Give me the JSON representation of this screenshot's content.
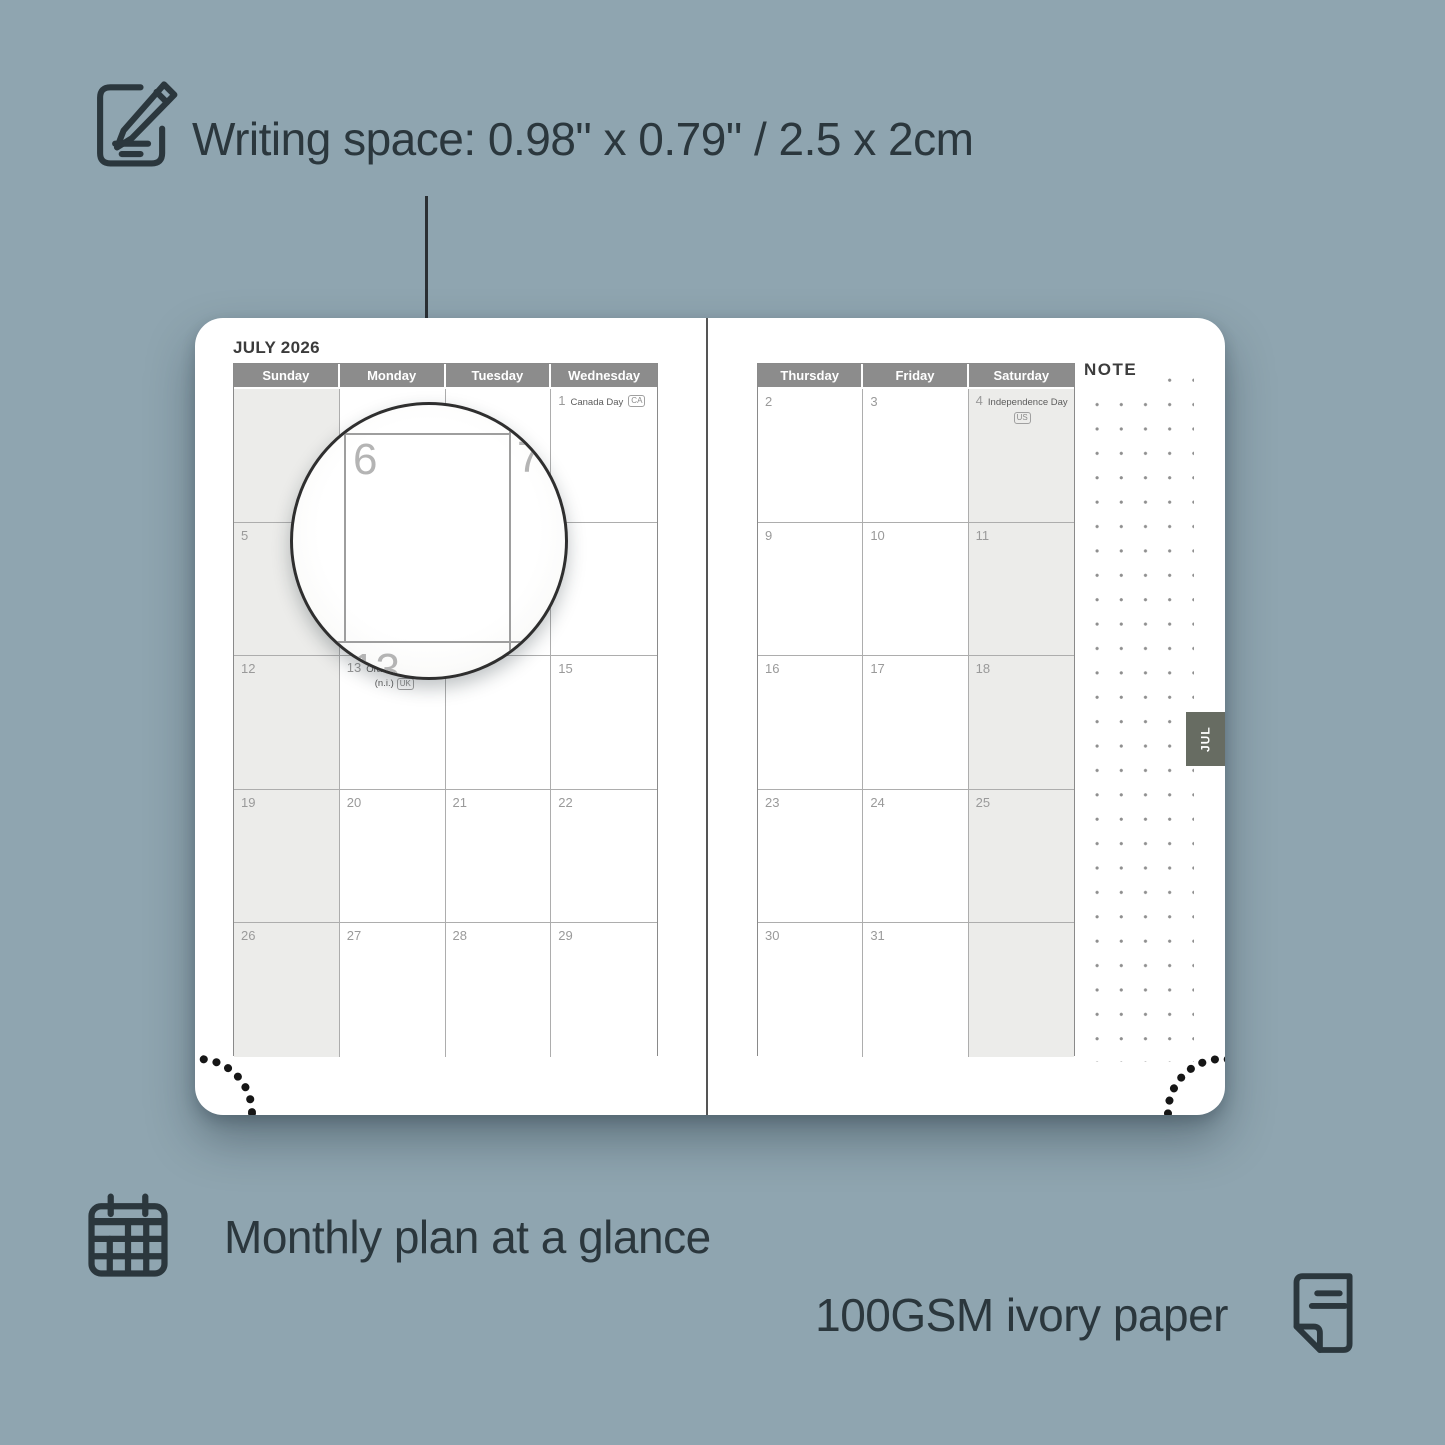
{
  "colors": {
    "bg": "#8fa5b0",
    "ink": "#2b373d",
    "band": "#8c8c8c",
    "page": "#ffffff",
    "shade": "#ececea",
    "tab-bg": "#676c62",
    "grid-line": "#adadad",
    "day-num": "#9a9a9a"
  },
  "captions": {
    "writing_space": "Writing space: 0.98\" x 0.79\" / 2.5 x 2cm",
    "monthly": "Monthly plan at a glance",
    "paper": "100GSM ivory paper"
  },
  "planner": {
    "month_title": "JULY 2026",
    "note_label": "NOTE",
    "tab_label": "JUL",
    "left_headers": [
      "Sunday",
      "Monday",
      "Tuesday",
      "Wednesday"
    ],
    "right_headers": [
      "Thursday",
      "Friday",
      "Saturday"
    ],
    "left_days": [
      [
        "",
        "",
        "",
        ""
      ],
      [
        "5",
        "6",
        "7",
        "8"
      ],
      [
        "12",
        "",
        "14",
        "15"
      ],
      [
        "19",
        "20",
        "21",
        "22"
      ],
      [
        "26",
        "27",
        "28",
        "29"
      ]
    ],
    "right_days": [
      [
        "2",
        "3",
        ""
      ],
      [
        "9",
        "10",
        "11"
      ],
      [
        "16",
        "17",
        "18"
      ],
      [
        "23",
        "24",
        "25"
      ],
      [
        "30",
        "31",
        ""
      ]
    ],
    "holidays": {
      "canada": {
        "day": "1",
        "name": "Canada Day",
        "badge": "CA"
      },
      "us": {
        "day": "4",
        "name": "Independence Day",
        "badge": "US"
      },
      "uk": {
        "day": "13",
        "name": "Orangemen's Day",
        "note": "(n.i.)",
        "badge": "UK"
      }
    }
  },
  "magnifier": {
    "main_day": "6",
    "right_day": "7",
    "bottom_day": "13"
  }
}
